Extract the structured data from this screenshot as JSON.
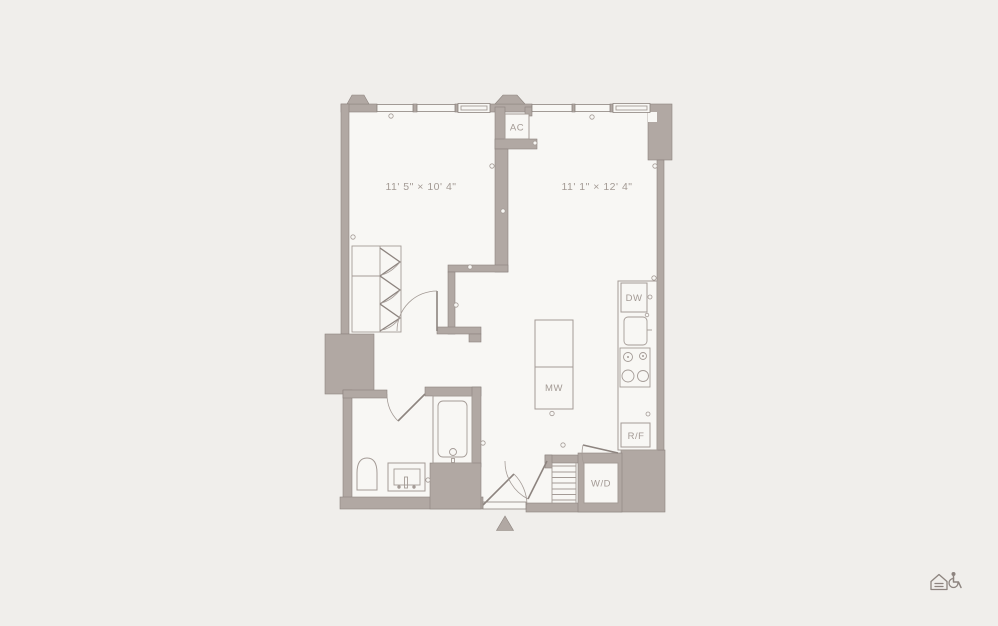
{
  "plan": {
    "rooms": [
      {
        "id": "bedroom",
        "dimensions": "11' 5\" × 10' 4\""
      },
      {
        "id": "living-kitchen",
        "dimensions": "11' 1\" × 12' 4\""
      }
    ],
    "labels": {
      "ac": "AC",
      "dishwasher": "DW",
      "microwave": "MW",
      "refrigerator": "R/F",
      "washer_dryer": "W/D"
    },
    "colors": {
      "background": "#f0eeeb",
      "floor": "#f8f7f4",
      "wall": "#b1a8a3",
      "line": "#8d847f",
      "fixture": "#a49b96",
      "text": "#a39a94"
    }
  },
  "footer": {
    "icons": [
      {
        "name": "equal-housing-icon"
      },
      {
        "name": "accessible-icon"
      }
    ]
  }
}
